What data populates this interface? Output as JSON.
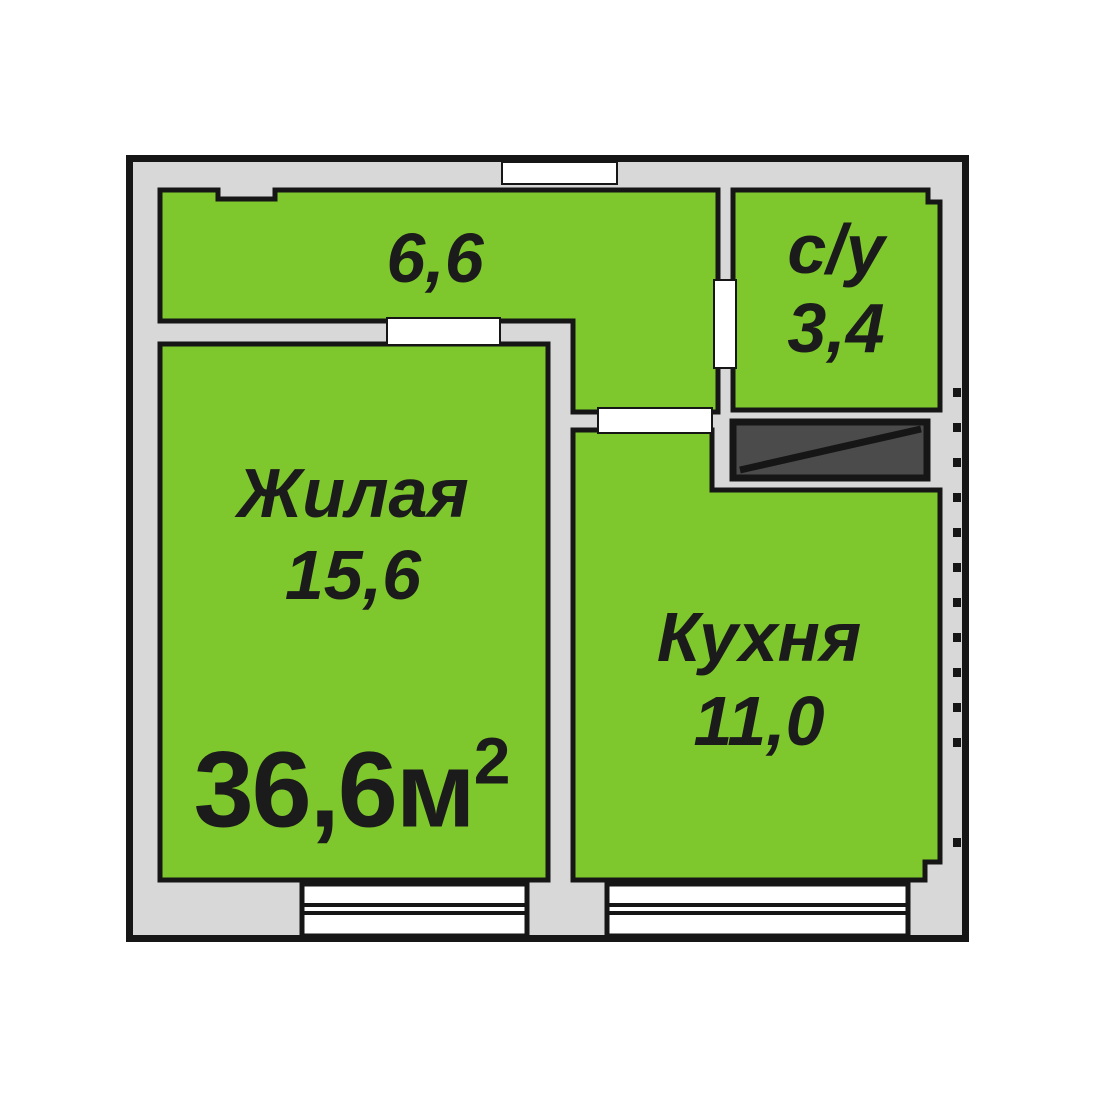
{
  "plan": {
    "type": "apartment-floor-plan",
    "total_area": {
      "value": "36,6м",
      "superscript": "2"
    },
    "rooms": [
      {
        "id": "hallway",
        "name_label": "",
        "area_label": "6,6"
      },
      {
        "id": "bathroom",
        "name_label": "с/у",
        "area_label": "3,4"
      },
      {
        "id": "living",
        "name_label": "Жилая",
        "area_label": "15,6"
      },
      {
        "id": "kitchen",
        "name_label": "Кухня",
        "area_label": "11,0"
      }
    ],
    "features": {
      "vent_shaft": "ventilation-shaft-with-diagonal",
      "windows_count": 2,
      "door_openings_count": 4
    },
    "colors": {
      "room_green": "#7ec72d",
      "wall_gray": "#d8d8d8",
      "vent_dark": "#4b4b4b",
      "line_black": "#161616",
      "window_white": "#ffffff",
      "text_black": "#1b1b1b",
      "background": "#ffffff"
    }
  }
}
